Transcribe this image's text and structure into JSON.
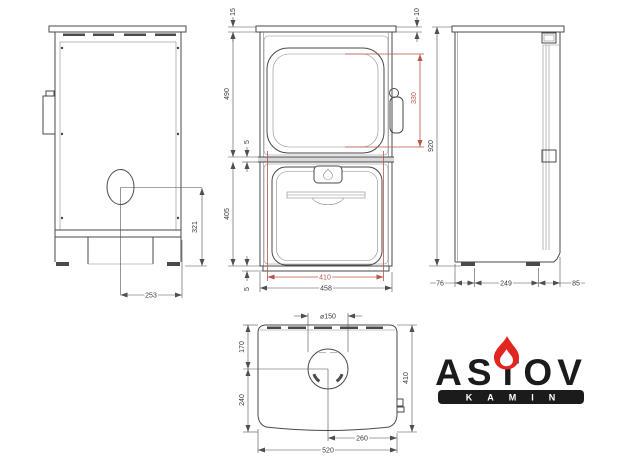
{
  "page": {
    "background": "#ffffff"
  },
  "colors": {
    "line": "#4a4a4a",
    "dim_red": "#b9544b",
    "brand_black": "#1b1b1b",
    "flame_red": "#e2261f"
  },
  "views": {
    "back": {
      "dims": {
        "flue_to_floor": "321",
        "flue_to_edge": "253"
      }
    },
    "front": {
      "dims": {
        "top_plate": "15",
        "upper_height": "490",
        "gap_top": "5",
        "lower_height": "405",
        "gap_bottom": "5",
        "glass_height": "330",
        "glass_width": "410",
        "body_width": "458",
        "plate_edge": "10"
      }
    },
    "side": {
      "dims": {
        "total_height": "920",
        "rear": "76",
        "base": "249",
        "front": "85"
      }
    },
    "top": {
      "dims": {
        "flue_diameter": "⌀150",
        "back_to_flue": "170",
        "flue_to_front": "240",
        "depth": "410",
        "flue_to_side": "260",
        "width": "520"
      }
    }
  },
  "logo": {
    "brand": "ASTOV",
    "subtitle": "KAMIN"
  }
}
